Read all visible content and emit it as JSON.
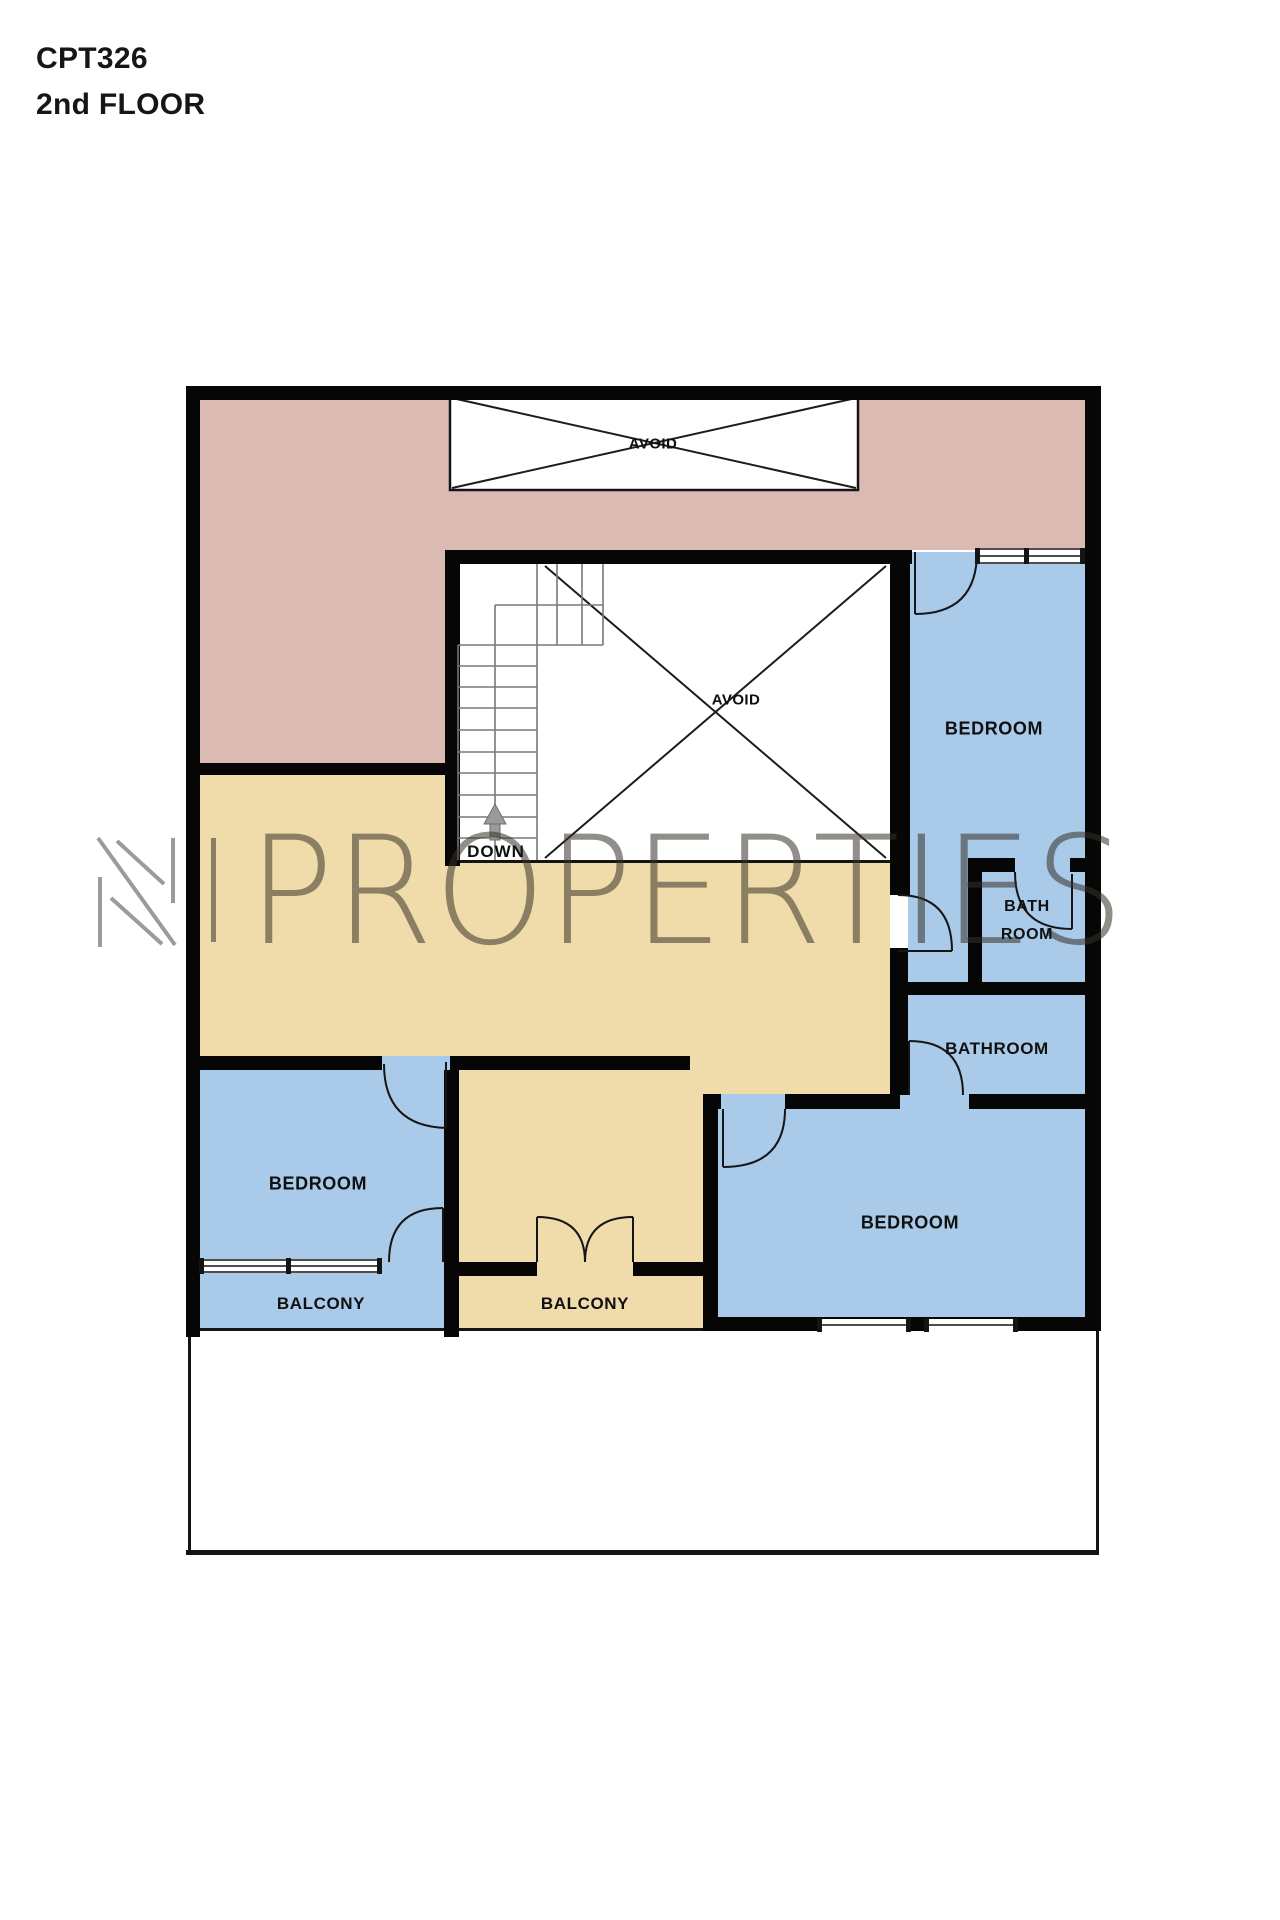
{
  "header": {
    "project_code": "CPT326",
    "floor": "2nd FLOOR"
  },
  "watermark": {
    "logo_letter": "N",
    "text": "PROPERTIES"
  },
  "colors": {
    "pink": "#DCBAB4",
    "tan": "#F0DCAA",
    "blue": "#A9CBE9",
    "wall": "#060606",
    "stair_line": "#787878",
    "arrow_gray": "#9A9A9A",
    "logo_gray": "#9B9B9B",
    "watermark_text": "rgba(55,50,40,0.55)"
  },
  "plan": {
    "labels": {
      "avoid_top": "AVOID",
      "avoid_stairwell": "AVOID",
      "down": "DOWN",
      "bedroom_right": "BEDROOM",
      "bath_line1": "BATH",
      "bath_line2": "ROOM",
      "bathroom": "BATHROOM",
      "bedroom_bottom": "BEDROOM",
      "bedroom_left": "BEDROOM",
      "balcony_left": "BALCONY",
      "balcony_middle": "BALCONY"
    }
  }
}
